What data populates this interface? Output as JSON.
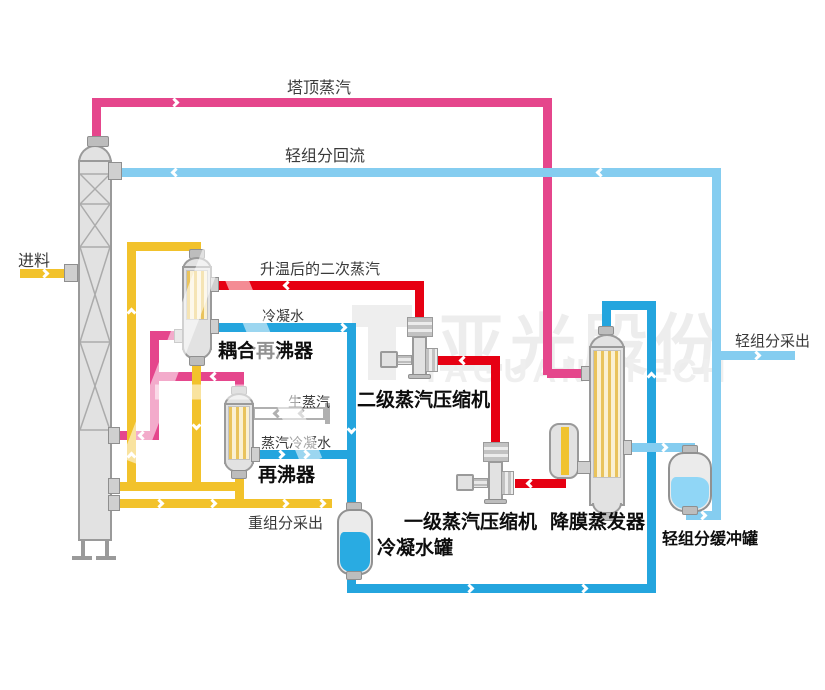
{
  "streams": {
    "top_steam": "塔顶蒸汽",
    "light_reflux": "轻组分回流",
    "feed": "进料",
    "heated_secondary_steam": "升温后的二次蒸汽",
    "condensate_water": "冷凝水",
    "raw_steam": "生蒸汽",
    "steam_condensate": "蒸汽冷凝水",
    "heavy_component_draw": "重组分采出",
    "light_component_draw": "轻组分采出"
  },
  "equipment": {
    "coupled_reboiler": "耦合再沸器",
    "reboiler": "再沸器",
    "stage2_steam_compressor": "二级蒸汽压缩机",
    "stage1_steam_compressor": "一级蒸汽压缩机",
    "falling_film_evaporator": "降膜蒸发器",
    "condensate_tank": "冷凝水罐",
    "light_component_buffer_tank": "轻组分缓冲罐"
  },
  "watermark": {
    "cn": "亚光股份",
    "en": "YAGUANGTECH"
  },
  "colors": {
    "overhead_vapor_pink": "#e5468c",
    "compressed_steam_red": "#e60012",
    "process_liquid_yellow": "#f2c22b",
    "condensate_blue": "#24a5de",
    "light_component_blue": "#85cdf0",
    "equipment_gray": "#e2e2e2"
  }
}
